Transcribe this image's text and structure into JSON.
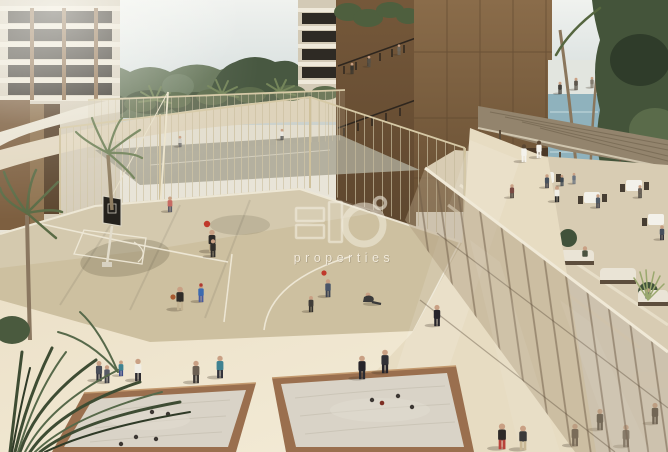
{
  "watermark": {
    "label": "properties"
  },
  "palette": {
    "sky_top": "#f0f2ef",
    "sky_bottom": "#ccd6d6",
    "foliage_dark": "#44543a",
    "foliage_mid": "#5d7050",
    "foliage_light": "#76866a",
    "left_building": "#d6cdba",
    "bronze_dark": "#5f4830",
    "bronze_light": "#8a6c4a",
    "pool_water": "#8fb2bd",
    "court": "#cdc0a0",
    "court_line": "#f0ead9",
    "cage_mesh": "#d2c5a2",
    "walkway": "#ece1c9",
    "path": "#e7dcc2",
    "sand": "#d9d3c7",
    "wood": "#9a6f4e",
    "boule": "#3c3733",
    "ball_red": "#c0392b",
    "basketball": "#a85a30",
    "screen_tint": "#a8926f",
    "screen_ledge": "#f0e9d7",
    "canopy": "#93846d",
    "terrace": "#d8ccb3",
    "sofa": "#eae4d6",
    "table": "#f3f1ea",
    "skin": "#c9a084"
  }
}
